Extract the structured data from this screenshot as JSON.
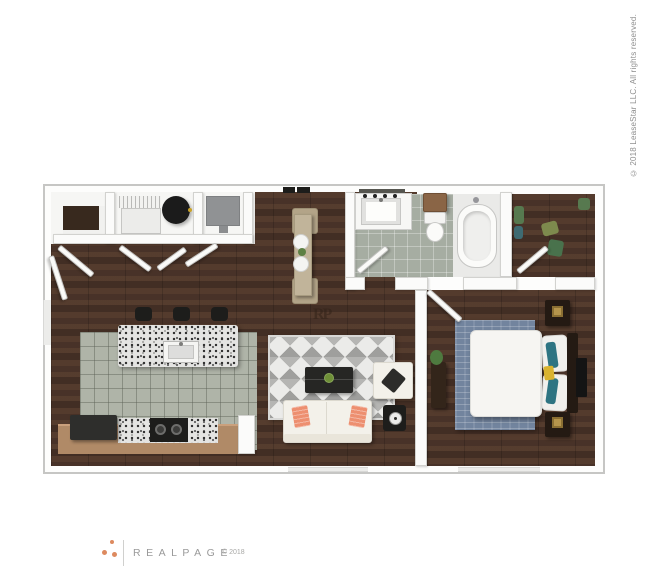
{
  "texts": {
    "vertical_copyright": "© 2018 LeaseStar LLC. All rights reserved.",
    "brand": "REALPAGE",
    "brand_copyright": "© 2018",
    "floor_watermark": "RP"
  },
  "colors": {
    "background": "#ffffff",
    "brand_dots": "#dd8a5f",
    "brand_text": "#9a9a9a",
    "copyright_text": "#8f8f8f",
    "walls": "#fbfbfa",
    "wood_floor": "#4a342a",
    "kitchen_tile": "#afb4a8",
    "bathroom_tile": "#a6ada2",
    "chevron_rug_grays": [
      "#ebebe9",
      "#b5b5b3",
      "#9f9f9d"
    ],
    "bedroom_rug_blue": "#72849e",
    "counter_tan": "#b08a67",
    "sofa_cream": "#f3f1ea",
    "accent_pillow_coral": "#ed8f70",
    "accent_pillow_teal": "#2e7482",
    "accent_pillow_yellow": "#d9b330",
    "dining_set_tan": "#b3a488",
    "nightstand_brown": "#241a13",
    "lamp_gold": "#b5954c"
  },
  "floorplan": {
    "type": "apartment-floor-plan-3d-top-view",
    "layout": "one-bedroom-one-bath",
    "rooms": [
      {
        "name": "entry-utility-closets",
        "contents": [
          "shelved closet",
          "wire shelf",
          "washer",
          "round water heater",
          "hvac unit",
          "bi-fold doors"
        ]
      },
      {
        "name": "dining-nook",
        "contents": [
          "narrow table",
          "2 chairs",
          "2 place settings",
          "plant sprig"
        ]
      },
      {
        "name": "kitchen",
        "contents": [
          "granite island with sink",
          "3 bar stools",
          "refrigerator",
          "cooktop",
          "tan counter",
          "tile floor"
        ]
      },
      {
        "name": "living-room",
        "contents": [
          "chevron rug",
          "coffee table with plant",
          "cream sofa with coral pillows",
          "armchair with dark pillow",
          "side table with fan"
        ]
      },
      {
        "name": "bathroom",
        "contents": [
          "vanity with sink",
          "vanity lights",
          "wood cabinet",
          "toilet",
          "bathtub"
        ]
      },
      {
        "name": "walk-in-closet",
        "contents": [
          "hanging clothes"
        ]
      },
      {
        "name": "bedroom",
        "contents": [
          "bed with white duvet",
          "headboard",
          "teal and yellow pillows",
          "2 nightstands with lamps",
          "dresser with plant",
          "wall tv",
          "blue area rug"
        ]
      }
    ]
  }
}
